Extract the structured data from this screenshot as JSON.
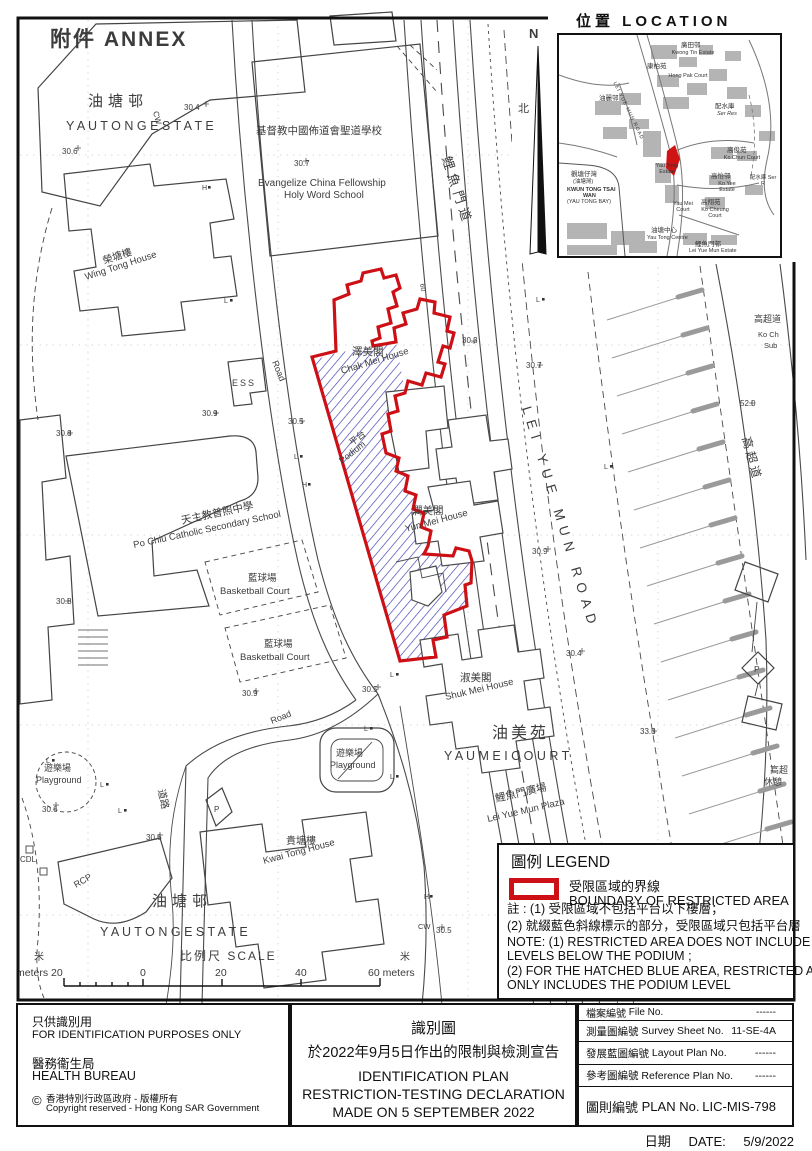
{
  "colors": {
    "boundary_red": "#cc1016",
    "hatch_blue": "#3a3aae"
  },
  "map": {
    "lamp_l": "L",
    "lamp_h": "H",
    "labels": {
      "annex": "附件  ANNEX",
      "yt1zh": "油塘邨",
      "yt1en": "Y A U   T O N G   E S T A T E",
      "sp306a": "30.6",
      "cwtop": "CW",
      "sp304": "30.4",
      "schzh": "基督教中國佈道會聖道學校",
      "sp307a": "30.7",
      "schen1": "Evangelize  China  Fellowship",
      "schen2": "Holy  Word  School",
      "wtzh": "榮塘樓",
      "wten": "Wing  Tong  House",
      "ess": "ESS",
      "roadmid": "Road",
      "sp305a": "30.5",
      "sp309a": "30.9",
      "sp308a": "30.8",
      "cmzh": "澤美閣",
      "cmen": "Chak  Mei  House",
      "sp303": "30.3",
      "sp307b": "30.7",
      "lymzh": "鯉魚門道",
      "lymen": "LEI  YUE  MUN  ROAD",
      "ptzh": "平台",
      "pten": "Podium",
      "ymzh": "潤美閣",
      "ymen": "Yun  Mei  House",
      "sp309b": "30.9",
      "r60": "60",
      "smzh": "淑美閣",
      "smen": "Shuk  Mei  House",
      "sp304b": "30.4",
      "sp305b": "30.5",
      "ymczh": "油美苑",
      "ymcen": "Y A U   M E I   C O U R T",
      "plzzh": "鯉魚門廣場",
      "plzen": "Lei  Yue  Mun  Plaza",
      "pg1zh": "遊樂場",
      "pg1en": "Playground",
      "sp306b": "30.6",
      "roadbot": "Road",
      "dlzh": "道路",
      "sp306c": "30.6",
      "rcp": "RCP",
      "cdl": "CDL",
      "ktzh": "貴塘樓",
      "kten": "Kwai  Tong  House",
      "pg2zh": "遊樂場",
      "pg2en": "Playground",
      "yt2zh": "油塘邨",
      "yt2en": "Y A U   T O N G   E S T A T E",
      "pczh": "天主教普照中學",
      "pcen": "Po  Chiu  Catholic  Secondary  School",
      "bb1zh": "藍球場",
      "bb1en": "Basketball  Court",
      "bb2zh": "藍球場",
      "bb2en": "Basketball  Court",
      "sp308b": "30.8",
      "sp309c": "30.9",
      "kczh": "高超道",
      "sp520": "52.0",
      "kczh2": "高超道",
      "kcen2a": "Ko Ch",
      "kcen2b": "Sub",
      "sp333": "33.3",
      "restzh1": "高超",
      "restzh2": "休憩",
      "cwbot": "CW",
      "sp305c": "30.5",
      "p1": "P",
      "p2": "P",
      "nN": "N",
      "nBei": "北"
    }
  },
  "scale": {
    "m_left": "米",
    "m_right": "米",
    "title": "比例尺   SCALE",
    "meters_left": "meters 20",
    "n0": "0",
    "n20": "20",
    "n40": "40",
    "n60": "60 meters"
  },
  "inset": {
    "title": "位置   LOCATION",
    "labels": {
      "kwongtin_zh": "廣田邨",
      "kwongtin_en": "Kwong Tin Estate",
      "hongpak_zh": "康柏苑",
      "hongpak_en": "Hong Pak Court",
      "serres_zh": "配水庫",
      "serres_en": "Ser Res",
      "yaulai_zh": "油麗邨",
      "kochun_zh": "高俊苑",
      "kochun_en": "Ko Chun Court",
      "bay_zh1": "觀塘仔灣",
      "bay_zh2": "(油塘灣)",
      "bay_en1": "KWUN TONG TSAI",
      "bay_en2": "WAN",
      "bay_en3": "(YAU TONG BAY)",
      "ytestate_en": "Yau Tong Estate",
      "koyee_zh": "高怡邨",
      "koyee_en": "Ko Yee Estate",
      "serres2": "配水庫 Ser R",
      "kocheung_zh": "高翔苑",
      "kocheung_en": "Ko Cheung Court",
      "yaumei_en": "Yau Mei Court",
      "ytcentre_zh": "油塘中心",
      "ytcentre_en": "Yau Tong Centre",
      "lyme_zh": "鯉魚門邨",
      "lyme_en": "Lei Yue Mun Estate",
      "road": "LEI YUE MUN ROAD"
    }
  },
  "legend": {
    "title": "圖例 LEGEND",
    "item_zh": "受限區域的界線",
    "item_en": "BOUNDARY OF RESTRICTED AREA",
    "note_zh1": "註 : (1) 受限區域不包括平台以下樓層；",
    "note_zh2": "(2) 就綴藍色斜線標示的部分，受限區域只包括平台層",
    "note_en1": "NOTE: (1) RESTRICTED AREA DOES NOT INCLUDE",
    "note_en2": "LEVELS BELOW THE PODIUM ;",
    "note_en3": "(2) FOR THE HATCHED BLUE AREA, RESTRICTED AREA",
    "note_en4": "ONLY INCLUDES THE PODIUM LEVEL"
  },
  "footer": {
    "left": {
      "zh1": "只供識別用",
      "en1": "FOR IDENTIFICATION PURPOSES ONLY",
      "zh2": "醫務衞生局",
      "en2": "HEALTH BUREAU",
      "copy_symbol": "©",
      "copy_zh": "香港特別行政區政府 - 版權所有",
      "copy_en": "Copyright reserved - Hong Kong SAR Government"
    },
    "center": {
      "zh1": "識別圖",
      "zh2": "於2022年9月5日作出的限制與檢測宣告",
      "en1": "IDENTIFICATION PLAN",
      "en2": "RESTRICTION-TESTING DECLARATION",
      "en3": "MADE ON 5 SEPTEMBER 2022"
    },
    "table": [
      {
        "zh": "檔案編號",
        "en": "File No.",
        "val": "------"
      },
      {
        "zh": "測量圖編號",
        "en": "Survey  Sheet  No.",
        "val": "11-SE-4A"
      },
      {
        "zh": "發展藍圖編號",
        "en": "Layout  Plan  No.",
        "val": "------"
      },
      {
        "zh": "參考圖編號",
        "en": "Reference  Plan  No.",
        "val": "------"
      },
      {
        "zh": "圖則編號",
        "en": "PLAN  No.",
        "val": "LIC-MIS-798"
      }
    ],
    "date": {
      "zh": "日期",
      "en": "DATE:",
      "val": "5/9/2022"
    }
  }
}
